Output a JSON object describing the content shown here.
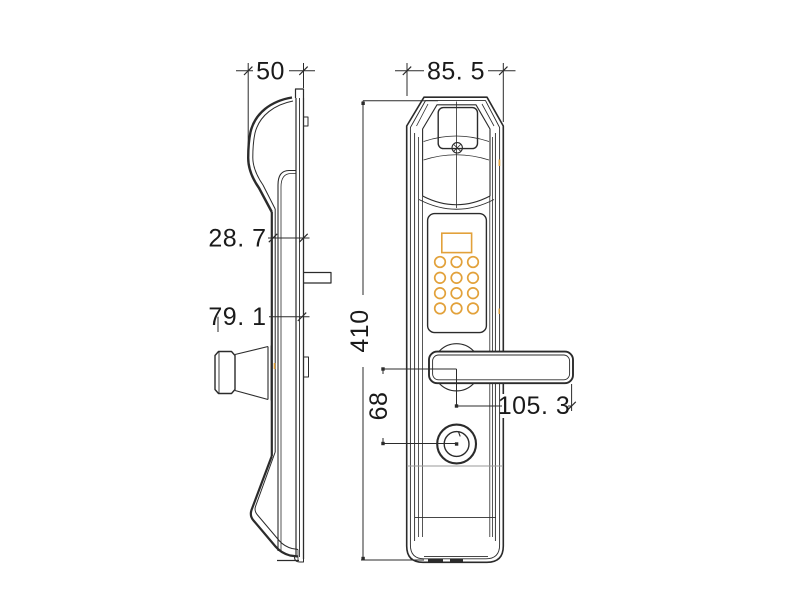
{
  "drawing_type": "technical-dimension-drawing",
  "dimensions": {
    "side_width": "50",
    "front_width": "85. 5",
    "mount_depth": "28. 7",
    "thumbturn_depth": "79. 1",
    "body_height": "410",
    "handle_to_keyhole": "68",
    "handle_length": "105. 3"
  },
  "colors": {
    "line": "#2b2b2b",
    "accent": "#e2a13a",
    "construction": "#9a9a9a",
    "text": "#1a1a1a",
    "background": "#ffffff"
  },
  "views": {
    "side_view": {
      "features": [
        "curved-escutcheon-profile",
        "mounting-plate",
        "thumbturn-knob",
        "spindle-tab"
      ]
    },
    "front_view": {
      "features": [
        "fingerprint-window",
        "screw",
        "keypad-display",
        "keypad-buttons",
        "lever-handle",
        "handle-boss",
        "keyhole"
      ],
      "keypad": {
        "rows": 4,
        "columns": 3,
        "button_count": 12
      }
    }
  }
}
